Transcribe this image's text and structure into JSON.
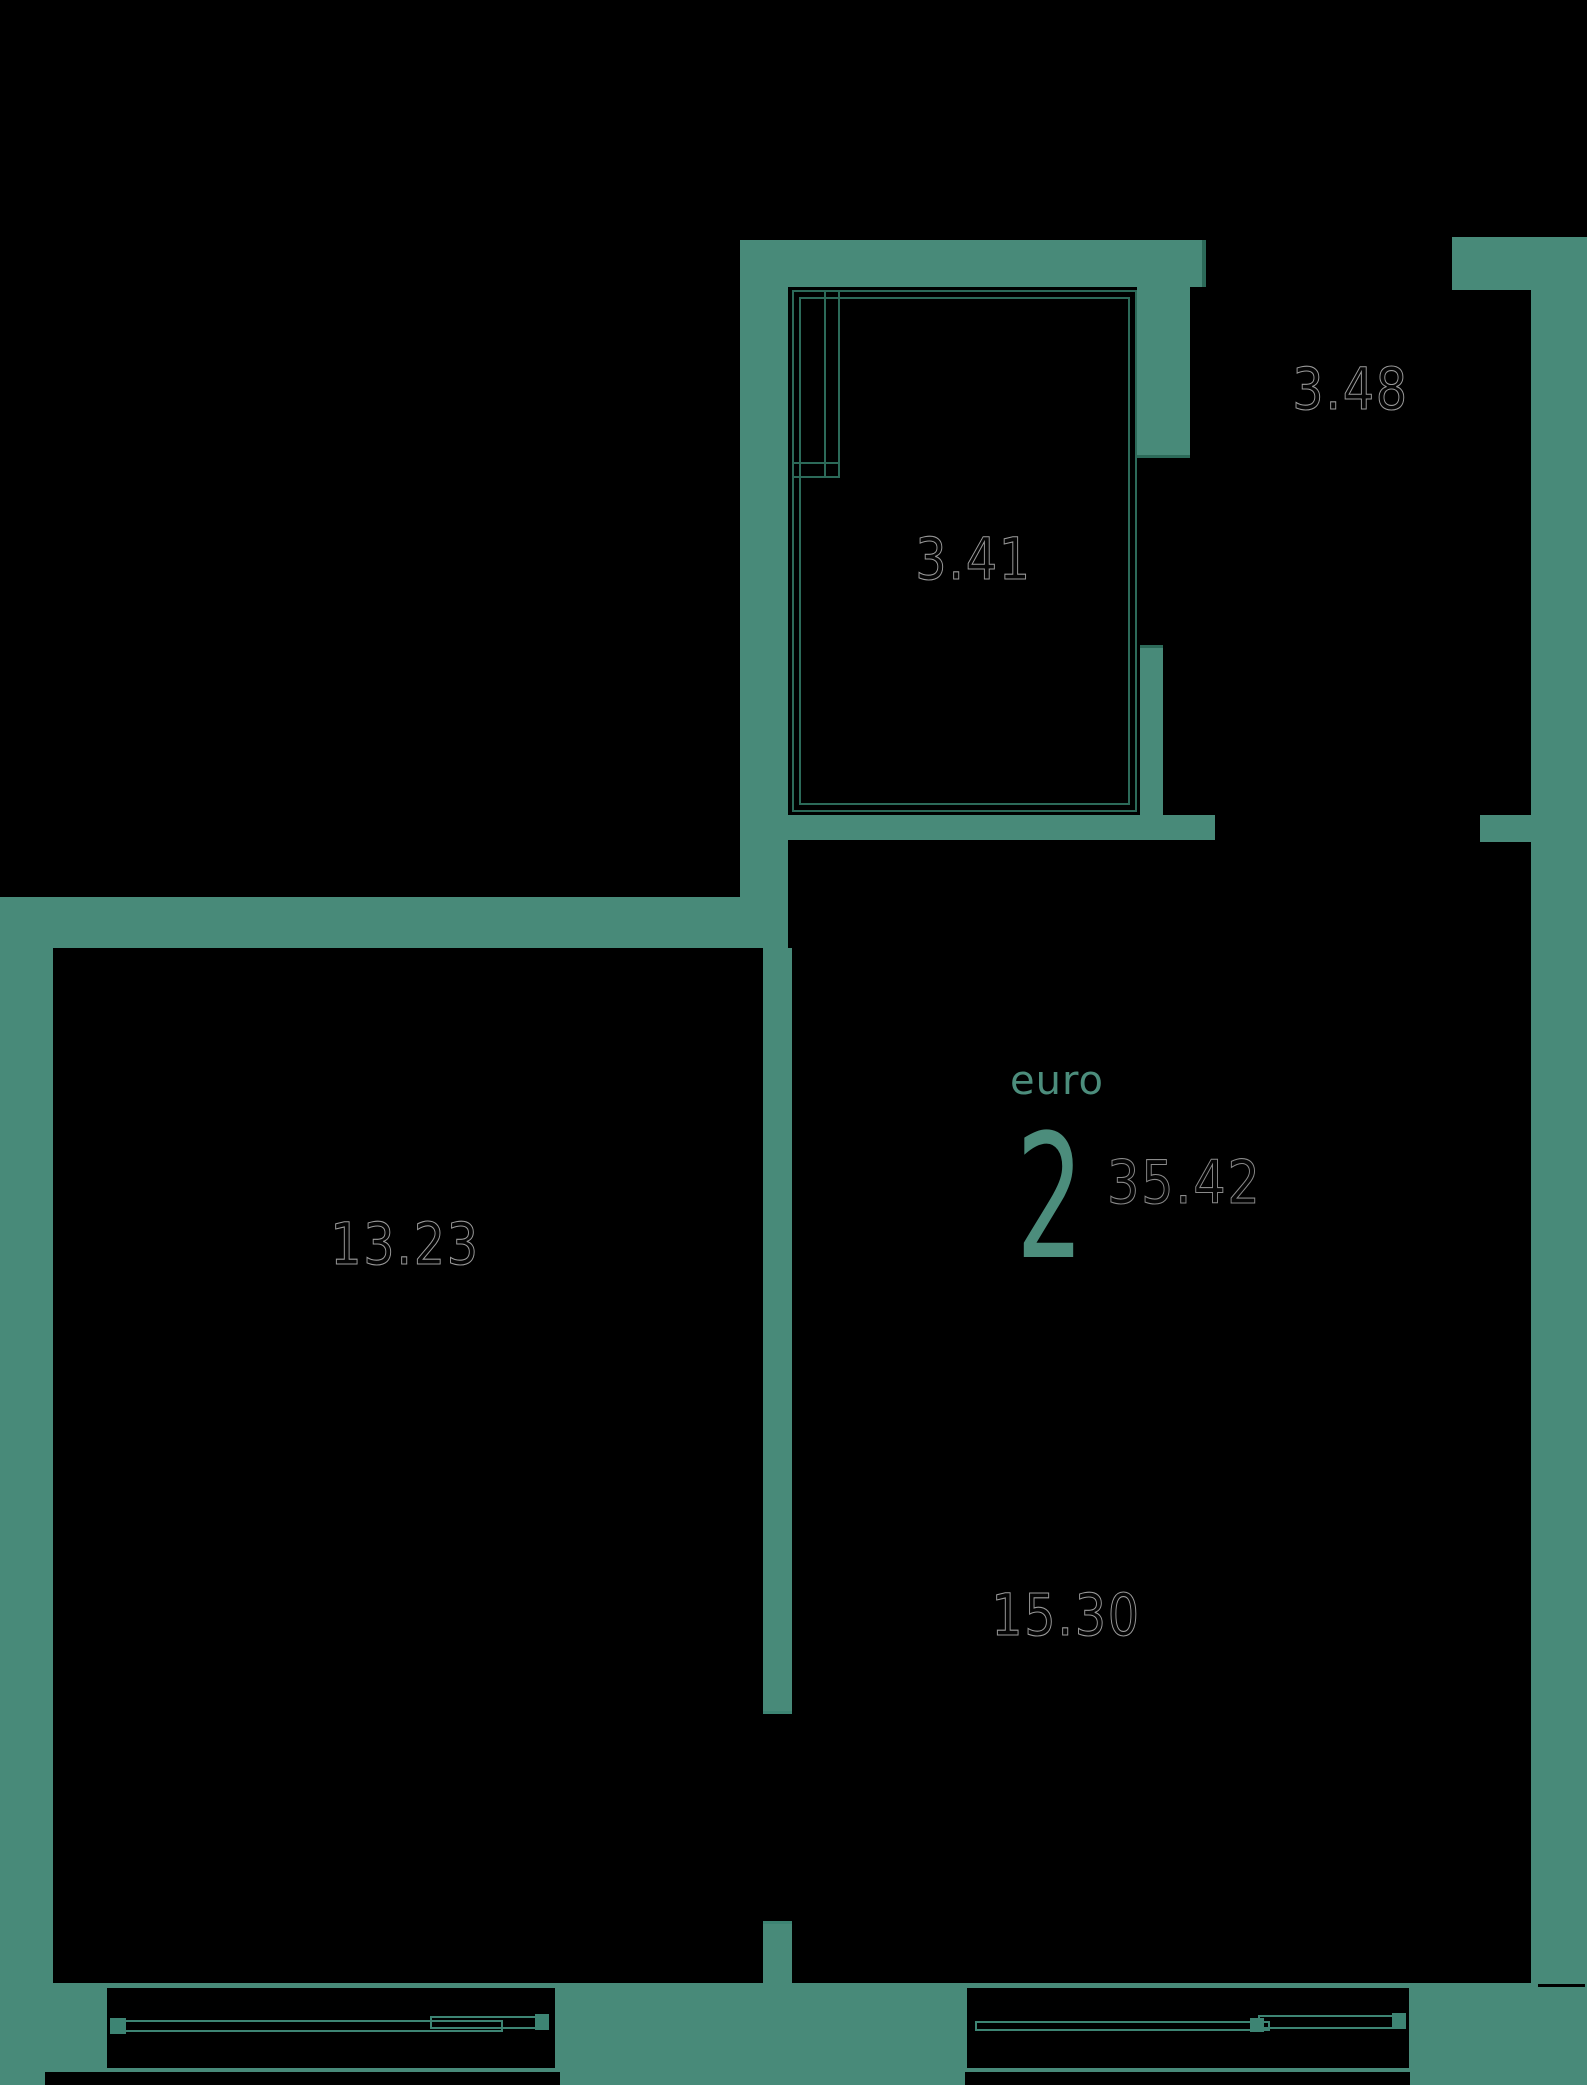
{
  "plan": {
    "title": {
      "unit_type_label": "euro",
      "unit_rooms_count": "2",
      "total_area": "35.42"
    },
    "rooms": [
      {
        "id": "bathroom",
        "area_label": "3.41"
      },
      {
        "id": "hallway",
        "area_label": "3.48"
      },
      {
        "id": "bedroom",
        "area_label": "13.23"
      },
      {
        "id": "living-room",
        "area_label": "15.30"
      }
    ],
    "colors": {
      "background": "#000000",
      "wall": "#488a79",
      "darkline": "#2c6a59",
      "bathline": "#2c6a59",
      "winline": "#3d8473",
      "tealtext": "#4c8d7c"
    }
  }
}
